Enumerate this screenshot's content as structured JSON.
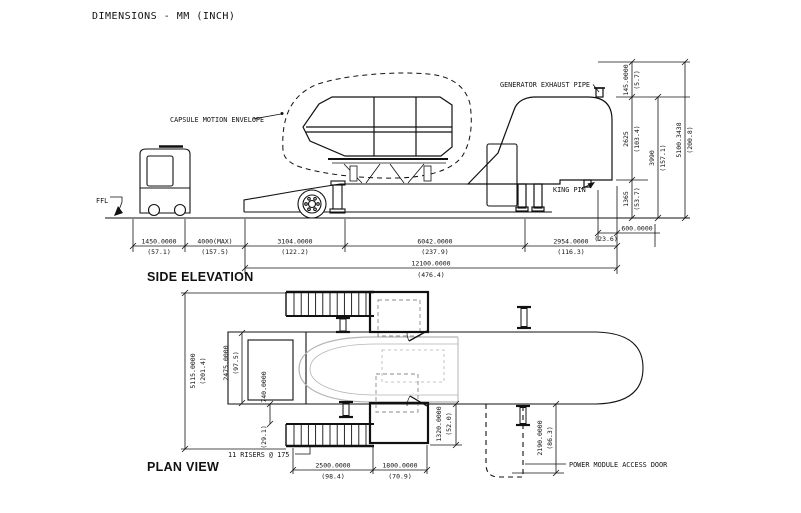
{
  "title": "DIMENSIONS - MM (INCH)",
  "side_elevation": {
    "section_label": "SIDE ELEVATION",
    "callouts": {
      "capsule_motion_envelope": "CAPSULE MOTION ENVELOPE",
      "generator_exhaust_pipe": "GENERATOR EXHAUST PIPE",
      "king_pin": "KING PIN",
      "ffl": "FFL"
    },
    "dims_h": [
      {
        "mm": "1450.0000",
        "in": "(57.1)"
      },
      {
        "mm": "4000(MAX)",
        "in": "(157.5)"
      },
      {
        "mm": "3104.0000",
        "in": "(122.2)"
      },
      {
        "mm": "6042.0000",
        "in": "(237.9)"
      },
      {
        "mm": "2954.0000",
        "in": "(116.3)"
      },
      {
        "mm": "600.0000",
        "in": "(23.6)"
      },
      {
        "mm": "12100.0000",
        "in": "(476.4)"
      }
    ],
    "dims_v": [
      {
        "mm": "145.0000",
        "in": "(5.7)"
      },
      {
        "mm": "2625",
        "in": "(103.4)"
      },
      {
        "mm": "3990",
        "in": "(157.1)"
      },
      {
        "mm": "5100.3438",
        "in": "(200.8)"
      },
      {
        "mm": "1365",
        "in": "(53.7)"
      }
    ]
  },
  "plan_view": {
    "section_label": "PLAN VIEW",
    "callouts": {
      "risers": "11 RISERS @ 175",
      "power_module_access_door": "POWER MODULE ACCESS DOOR"
    },
    "dims_v": [
      {
        "mm": "5115.0000",
        "in": "(201.4)"
      },
      {
        "mm": "2475.0000",
        "in": "(97.5)"
      },
      {
        "mm": "740.0000",
        "in": "(29.1)"
      },
      {
        "mm": "1320.0000",
        "in": "(52.0)"
      },
      {
        "mm": "2190.0000",
        "in": "(86.3)"
      }
    ],
    "dims_h": [
      {
        "mm": "2500.0000",
        "in": "(98.4)"
      },
      {
        "mm": "1800.0000",
        "in": "(70.9)"
      }
    ]
  }
}
